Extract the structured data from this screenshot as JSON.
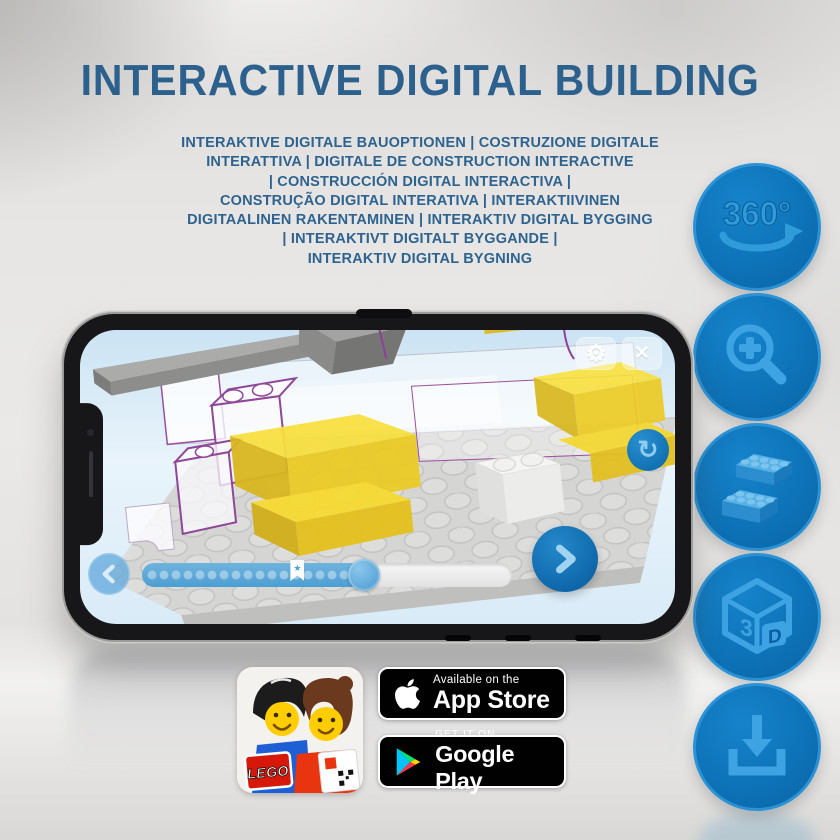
{
  "header": {
    "title": "INTERACTIVE DIGITAL BUILDING"
  },
  "subtitle_lines": [
    "INTERAKTIVE DIGITALE BAUOPTIONEN | COSTRUZIONE DIGITALE",
    "INTERATTIVA | DIGITALE DE CONSTRUCTION INTERACTIVE",
    "| CONSTRUCCIÓN DIGITAL INTERACTIVA |",
    "CONSTRUÇÃO DIGITAL INTERATIVA | INTERAKTIIVINEN",
    "DIGITAALINEN RAKENTAMINEN | INTERAKTIV DIGITAL BYGGING",
    "| INTERAKTIVT DIGITALT BYGGANDE |",
    "INTERAKTIV DIGITAL BYGNING"
  ],
  "features": [
    {
      "id": "rotate-360",
      "label": "360°"
    },
    {
      "id": "zoom-in"
    },
    {
      "id": "lego-bricks"
    },
    {
      "id": "3d-view",
      "label_left": "3",
      "label_right": "D"
    },
    {
      "id": "download"
    }
  ],
  "phone": {
    "app": {
      "icons": {
        "gear": "⚙",
        "close": "✕",
        "rotate": "↻",
        "bookmark_star": "★"
      },
      "progress": {
        "fill_percent": 60,
        "handle_percent": 60,
        "bookmark_percent": 42
      }
    }
  },
  "badges": {
    "app_store": {
      "line1": "Available on the",
      "line2": "App Store"
    },
    "google_play": {
      "line1": "GET IT ON",
      "line2": "Google Play"
    },
    "lego_app": {
      "logo_text": "LEGO"
    }
  },
  "colors": {
    "title_blue": "#2d618d",
    "circle_blue": "#0e73b8",
    "circle_ring": "#2b92d6",
    "glyph_blue": "#3da3e2",
    "brick_yellow": "#f6da30",
    "play_green": "#00e571",
    "play_cyan": "#00c4ff",
    "play_yellow": "#ffd400",
    "play_red": "#ff3a44",
    "lego_red": "#d6180b"
  }
}
